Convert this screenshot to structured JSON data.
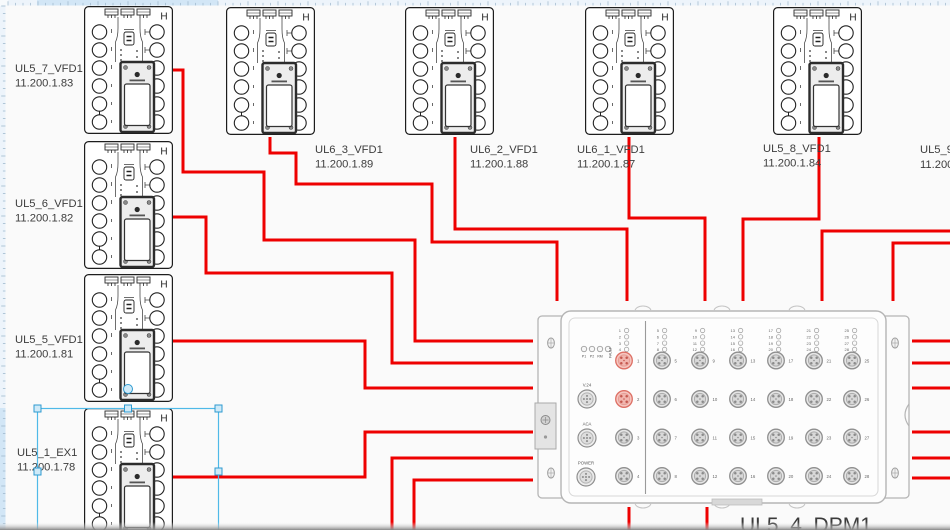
{
  "canvas": {
    "width": 950,
    "height": 530,
    "bg": "#fafafa",
    "wire_color": "#ee0000",
    "wire_width": 3
  },
  "rulers": {
    "bg": "#edf4fb",
    "tick_color": "#9cb6cb",
    "highlight": "#d2e6f6",
    "top_highlight_range": [
      37,
      218
    ],
    "left_highlight_range": [
      408,
      530
    ]
  },
  "devices": [
    {
      "name": "UL5_7_VFD1",
      "ip": "11.200.1.83",
      "x": 84,
      "y": 6,
      "label_x": 15,
      "label_y": 72
    },
    {
      "name": "UL5_6_VFD1",
      "ip": "11.200.1.82",
      "x": 84,
      "y": 141,
      "label_x": 15,
      "label_y": 207
    },
    {
      "name": "UL5_5_VFD1",
      "ip": "11.200.1.81",
      "x": 84,
      "y": 274,
      "label_x": 15,
      "label_y": 343
    },
    {
      "name": "UL5_1_EX1",
      "ip": "11.200.1.78",
      "x": 84,
      "y": 408,
      "label_x": 17,
      "label_y": 456,
      "selected": true
    },
    {
      "name": "UL6_3_VFD1",
      "ip": "11.200.1.89",
      "x": 226,
      "y": 7,
      "label_x": 315,
      "label_y": 153
    },
    {
      "name": "UL6_2_VFD1",
      "ip": "11.200.1.88",
      "x": 405,
      "y": 7,
      "label_x": 470,
      "label_y": 153
    },
    {
      "name": "UL6_1_VFD1",
      "ip": "11.200.1.87",
      "x": 585,
      "y": 7,
      "label_x": 577,
      "label_y": 153
    },
    {
      "name": "UL5_8_VFD1",
      "ip": "11.200.1.84",
      "x": 773,
      "y": 7,
      "label_x": 763,
      "label_y": 152
    }
  ],
  "offscreen_device_label": {
    "name": "UL5_9_V",
    "ip": "11.200.",
    "x": 920,
    "y": 153
  },
  "dpm": {
    "label": "UL5_4_DPM1",
    "label_x": 740,
    "label_y": 532,
    "label_size": 21,
    "status_leds": [
      "P1",
      "P2",
      "RM",
      "FAULT"
    ],
    "aux_connectors": [
      "V.24",
      "ACA",
      "POWER"
    ],
    "left_port_numbers": [
      1,
      2,
      3,
      4
    ],
    "active_ports": [
      1,
      2
    ],
    "grid_port_columns": [
      [
        5,
        6,
        7,
        8
      ],
      [
        9,
        10,
        11,
        12
      ],
      [
        13,
        14,
        15,
        16
      ],
      [
        17,
        18,
        19,
        20
      ],
      [
        21,
        22,
        23,
        24
      ],
      [
        25,
        26,
        27,
        28
      ]
    ],
    "active_color": "#dd6f64"
  },
  "connections": [
    {
      "id": "UL5_7_VFD1-to-DPM",
      "points": [
        [
          173,
          70
        ],
        [
          183,
          70
        ],
        [
          183,
          172
        ],
        [
          264,
          172
        ],
        [
          264,
          240
        ],
        [
          415,
          240
        ],
        [
          415,
          341
        ],
        [
          533,
          341
        ]
      ]
    },
    {
      "id": "UL5_6_VFD1-to-DPM",
      "points": [
        [
          173,
          217
        ],
        [
          206,
          217
        ],
        [
          206,
          273
        ],
        [
          392,
          273
        ],
        [
          392,
          363
        ],
        [
          533,
          363
        ]
      ]
    },
    {
      "id": "UL5_5_VFD1-to-DPM",
      "points": [
        [
          173,
          341
        ],
        [
          365,
          341
        ],
        [
          365,
          388
        ],
        [
          533,
          388
        ]
      ]
    },
    {
      "id": "UL5_1_EX1-to-DPM",
      "points": [
        [
          173,
          477
        ],
        [
          365,
          477
        ],
        [
          365,
          432
        ],
        [
          533,
          432
        ]
      ]
    },
    {
      "id": "UL6_3_VFD1-to-DPM",
      "points": [
        [
          270,
          137
        ],
        [
          270,
          153
        ],
        [
          296,
          153
        ],
        [
          296,
          184
        ],
        [
          432,
          184
        ],
        [
          432,
          242
        ],
        [
          557,
          242
        ],
        [
          557,
          301
        ]
      ]
    },
    {
      "id": "UL6_2_VFD1-to-DPM",
      "points": [
        [
          455,
          137
        ],
        [
          455,
          229
        ],
        [
          627,
          229
        ],
        [
          627,
          301
        ]
      ]
    },
    {
      "id": "UL6_1_VFD1-to-DPM",
      "points": [
        [
          629,
          137
        ],
        [
          629,
          218
        ],
        [
          705,
          218
        ],
        [
          705,
          301
        ]
      ]
    },
    {
      "id": "UL5_8_VFD1-to-DPM",
      "points": [
        [
          819,
          137
        ],
        [
          819,
          219
        ],
        [
          743,
          219
        ],
        [
          743,
          301
        ]
      ]
    },
    {
      "id": "right-edge-in-1",
      "points": [
        [
          950,
          231
        ],
        [
          822,
          231
        ],
        [
          822,
          301
        ]
      ]
    },
    {
      "id": "right-edge-in-2",
      "points": [
        [
          950,
          243
        ],
        [
          893,
          243
        ],
        [
          893,
          301
        ]
      ]
    },
    {
      "id": "bottom-edge-in-1",
      "points": [
        [
          392,
          530
        ],
        [
          392,
          458
        ],
        [
          533,
          458
        ]
      ]
    },
    {
      "id": "bottom-edge-in-2",
      "points": [
        [
          414,
          530
        ],
        [
          414,
          480
        ],
        [
          533,
          480
        ]
      ]
    },
    {
      "id": "dpm-right-stub-1",
      "points": [
        [
          912,
          341
        ],
        [
          950,
          341
        ]
      ]
    },
    {
      "id": "dpm-right-stub-2",
      "points": [
        [
          912,
          363
        ],
        [
          950,
          363
        ]
      ]
    },
    {
      "id": "dpm-right-stub-3",
      "points": [
        [
          912,
          388
        ],
        [
          950,
          388
        ]
      ]
    },
    {
      "id": "dpm-right-stub-4",
      "points": [
        [
          912,
          432
        ],
        [
          950,
          432
        ]
      ]
    },
    {
      "id": "dpm-right-stub-5",
      "points": [
        [
          912,
          458
        ],
        [
          950,
          458
        ]
      ]
    },
    {
      "id": "dpm-right-stub-6",
      "points": [
        [
          912,
          478
        ],
        [
          950,
          478
        ]
      ]
    },
    {
      "id": "dpm-bottom-stub-1",
      "points": [
        [
          629,
          507
        ],
        [
          629,
          530
        ]
      ]
    },
    {
      "id": "dpm-bottom-stub-2",
      "points": [
        [
          707,
          507
        ],
        [
          707,
          530
        ]
      ]
    }
  ],
  "selection": {
    "x": 37.5,
    "y": 408.5,
    "width": 181,
    "height": 140,
    "border": "#4fb9e8",
    "handle_fill": "#cfeaf8",
    "handle_border": "#2e9ad0"
  }
}
